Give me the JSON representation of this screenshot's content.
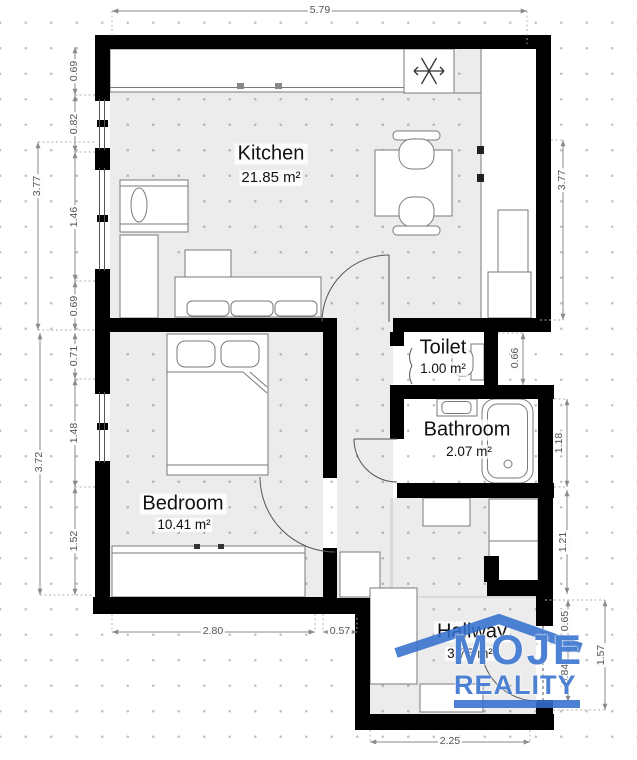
{
  "plan": {
    "rooms": {
      "kitchen": {
        "name": "Kitchen",
        "area": "21.85 m²"
      },
      "toilet": {
        "name": "Toilet",
        "area": "1.00 m²"
      },
      "bathroom": {
        "name": "Bathroom",
        "area": "2.07 m²"
      },
      "bedroom": {
        "name": "Bedroom",
        "area": "10.41 m²"
      },
      "hallway": {
        "name": "Hallway",
        "area": "3.75 m²"
      }
    },
    "dims": {
      "top": "5.79",
      "left": {
        "outer_top": "3.77",
        "outer_bottom": "3.72",
        "seg1": "0.69",
        "seg2": "0.82",
        "seg3": "1.46",
        "seg4": "0.69",
        "seg5": "0.71",
        "seg6": "1.48",
        "seg7": "1.52"
      },
      "right": {
        "outer": "3.77",
        "toilet": "0.66",
        "bath_top": "1.18",
        "bath_bottom": "1.21",
        "hall_top": "0.65",
        "hall_mid": "0.84",
        "hall_total": "1.57"
      },
      "bottom": {
        "bedroom": "2.80",
        "offset": "0.57",
        "hallway": "2.25"
      }
    },
    "colors": {
      "wall": "#000000",
      "floor_tint": "#ebebeb",
      "dim_text": "#555555",
      "logo_blue": "#3470cd"
    }
  },
  "logo": {
    "top": "MOJE",
    "bottom": "REALITY"
  }
}
